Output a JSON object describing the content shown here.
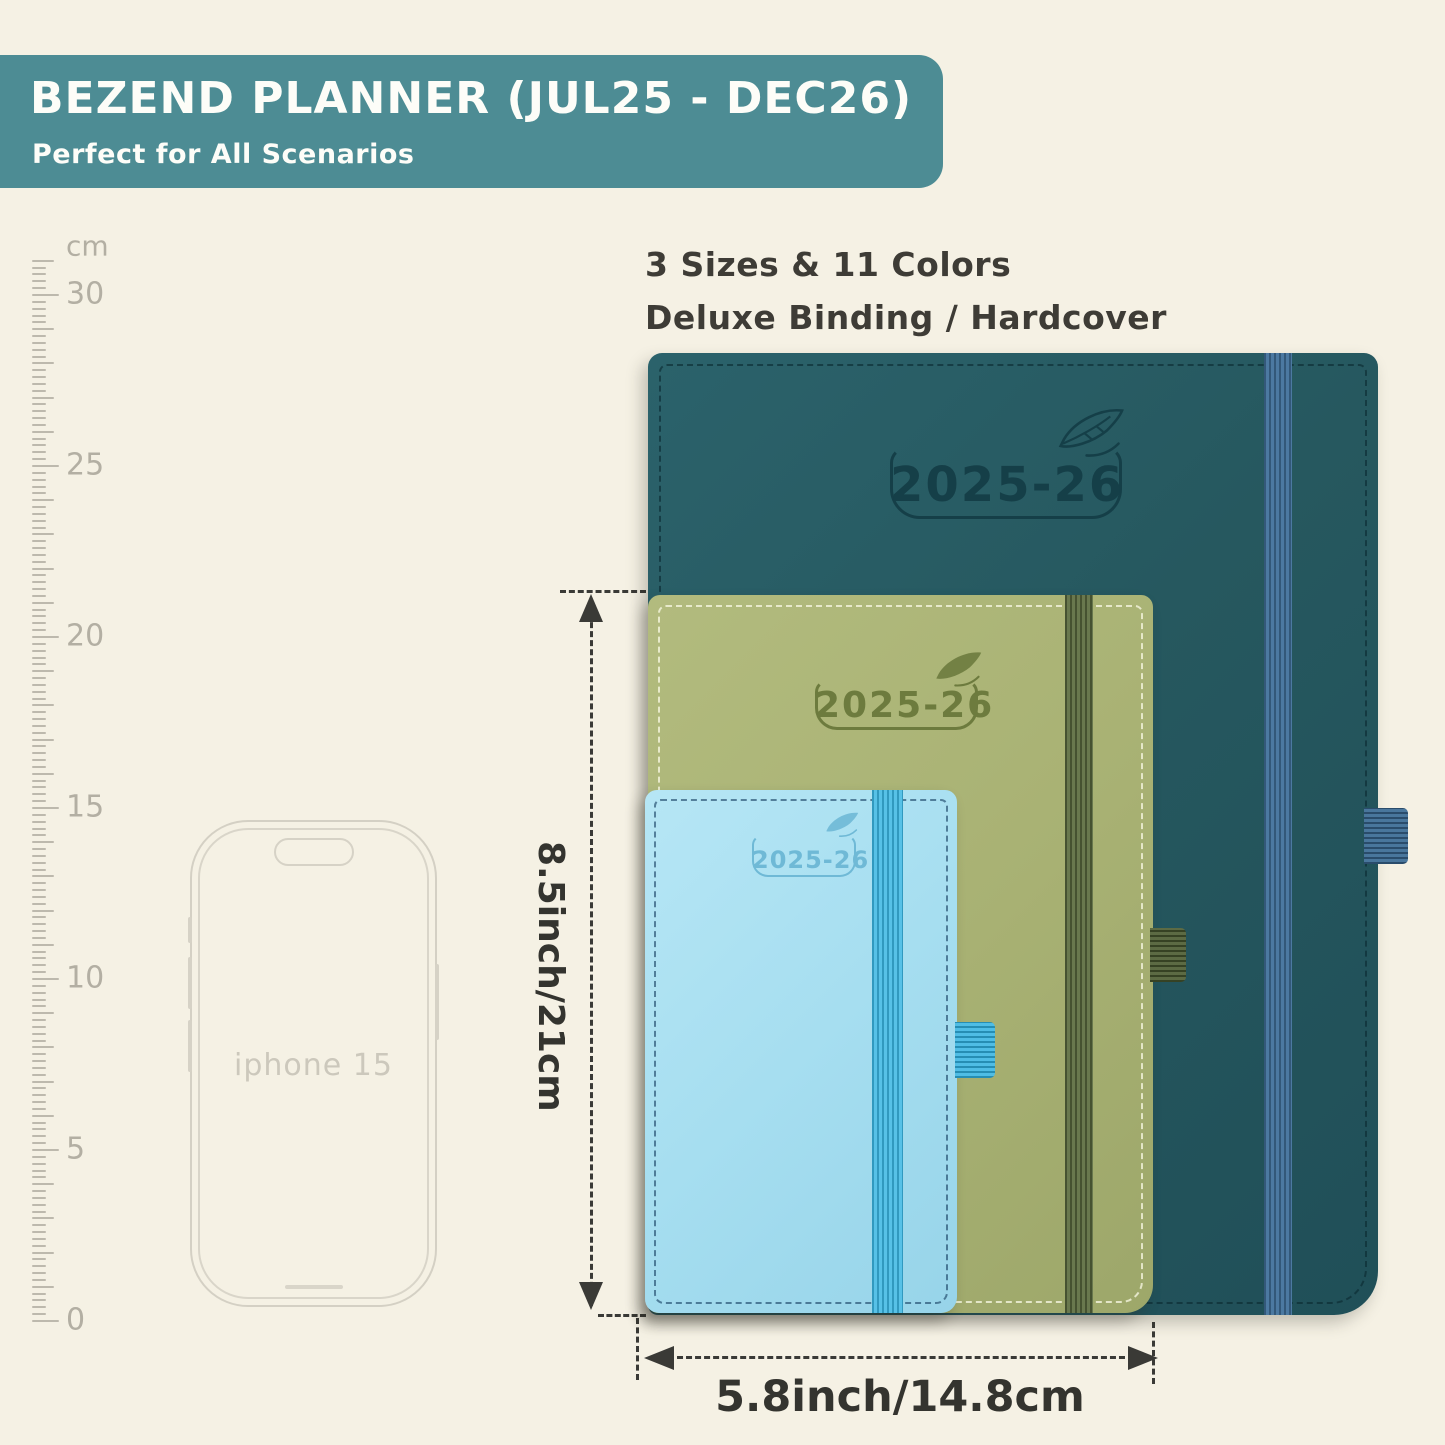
{
  "banner": {
    "title": "BEZEND PLANNER (JUL25 - DEC26)",
    "subtitle": "Perfect for All Scenarios",
    "bg_color": "#4d8c94",
    "text_color": "#fdfdf8"
  },
  "features": {
    "line1": "3 Sizes & 11 Colors",
    "line2": "Deluxe Binding / Hardcover"
  },
  "ruler": {
    "unit": "cm",
    "min_cm": 0,
    "max_cm": 31,
    "labeled_marks": [
      30,
      25,
      20,
      15,
      10,
      5,
      0
    ],
    "px_per_cm": 34.2,
    "zero_y": 1320
  },
  "phone": {
    "label": "iphone 15"
  },
  "planners": [
    {
      "id": "large-teal",
      "year": "2025-26",
      "cover_color": "#26585f",
      "elastic_color": "#41719b",
      "loop_color": "#3a6a94",
      "engraving_color": "#153f48"
    },
    {
      "id": "medium-green",
      "year": "2025-26",
      "cover_color": "#a9b274",
      "elastic_color": "#5e6e41",
      "loop_color": "#4e5e34",
      "engraving_color": "#6d7b3e"
    },
    {
      "id": "small-blue",
      "year": "2025-26",
      "cover_color": "#a6def0",
      "elastic_color": "#3ab6e3",
      "loop_color": "#30b2e1",
      "engraving_color": "#6fb9d6"
    }
  ],
  "dimensions": {
    "height_label": "8.5inch/21cm",
    "width_label": "5.8inch/14.8cm",
    "annotation_color": "#3a3a36"
  }
}
